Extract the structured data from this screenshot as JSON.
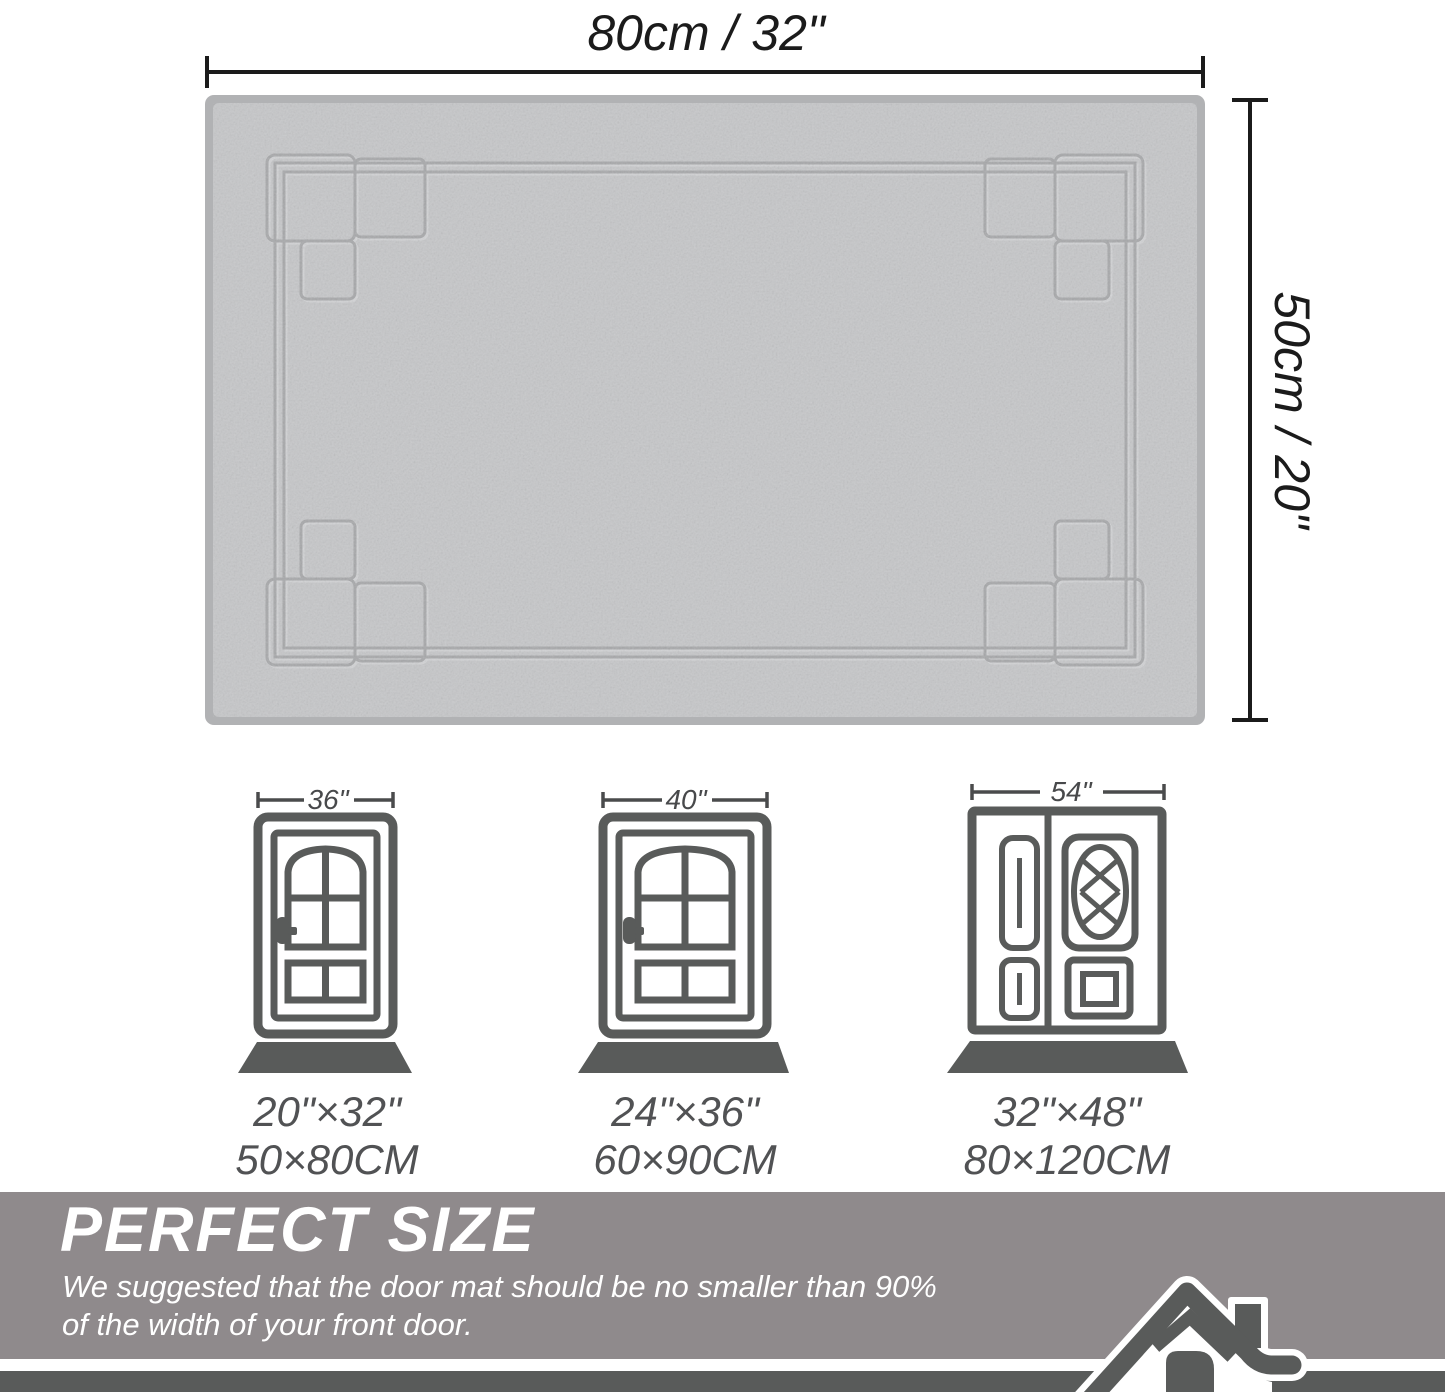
{
  "rug": {
    "width_label": "80cm / 32\"",
    "height_label": "50cm / 20\"",
    "base_color": "#c6c7c9",
    "binding_color": "#b1b2b4",
    "pattern_line_color": "#a4a5a7"
  },
  "dimension_color": "#1b1b1b",
  "doors": [
    {
      "type": "single",
      "door_width": "36\"",
      "mat_size_in": "20\"×32\"",
      "mat_size_cm": "50×80CM"
    },
    {
      "type": "single",
      "door_width": "40\"",
      "mat_size_in": "24\"×36\"",
      "mat_size_cm": "60×90CM"
    },
    {
      "type": "double",
      "door_width": "54\"",
      "mat_size_in": "32\"×48\"",
      "mat_size_cm": "80×120CM"
    }
  ],
  "door_icon_color": "#595b5a",
  "banner": {
    "title": "PERFECT SIZE",
    "subtitle_line1": "We suggested that the door mat should be no smaller than 90%",
    "subtitle_line2": "of the width of your front door.",
    "bg_color": "#8f8a8c",
    "text_color": "#ffffff"
  },
  "footer_bar_color": "#595b5a"
}
